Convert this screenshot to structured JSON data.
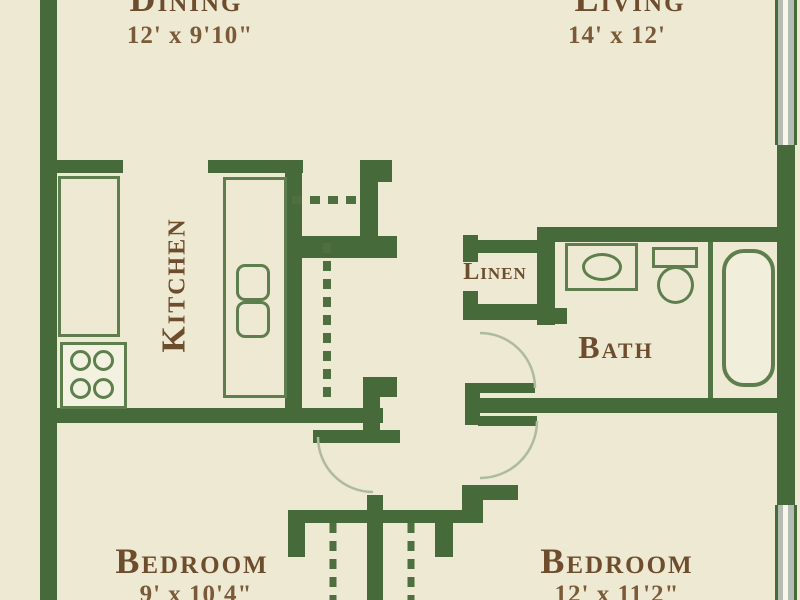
{
  "rooms": {
    "dining": {
      "name": "Dining",
      "dims": "12' x 9'10\""
    },
    "living": {
      "name": "Living",
      "dims": "14' x 12'"
    },
    "kitchen": {
      "name": "Kitchen"
    },
    "linen": {
      "name": "Linen"
    },
    "bath": {
      "name": "Bath"
    },
    "bedroom_left": {
      "name": "Bedroom",
      "dims": "9' x 10'4\""
    },
    "bedroom_right": {
      "name": "Bedroom",
      "dims": "12' x 11'2\""
    }
  },
  "colors": {
    "background": "#EDE9D2",
    "wall_green": "#476A3A",
    "fixture_outline": "#5E7F4D",
    "room_label_brown": "#6E4D2E",
    "dimension_brown": "#7B5A3A",
    "window_gray": "#B7BCB2",
    "door_arc": "#B0BA9D"
  }
}
